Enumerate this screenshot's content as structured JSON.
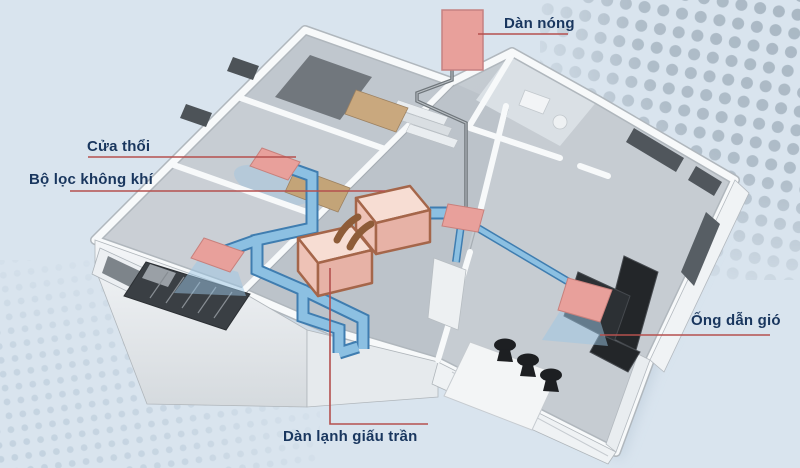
{
  "diagram": {
    "labels": {
      "outdoor_unit": "Dàn nóng",
      "blow_vent": "Cửa thổi",
      "air_filter": "Bộ lọc không khí",
      "air_duct": "Ống dẫn gió",
      "concealed_ceiling_unit": "Dàn lạnh giấu trần"
    },
    "colors": {
      "background": "#d9e4ee",
      "label_text": "#19365e",
      "leader_line": "#b5504e",
      "unit_pink": "#e8a09b",
      "unit_box_border": "#a5664a",
      "duct_blue": "#8cc0e2",
      "duct_border": "#3f7db0",
      "pipe_brown": "#8e5c38",
      "pipe_gray": "#6f767b",
      "dots_large": "#a9b7c3",
      "dots_small": "#c3d2df"
    }
  }
}
